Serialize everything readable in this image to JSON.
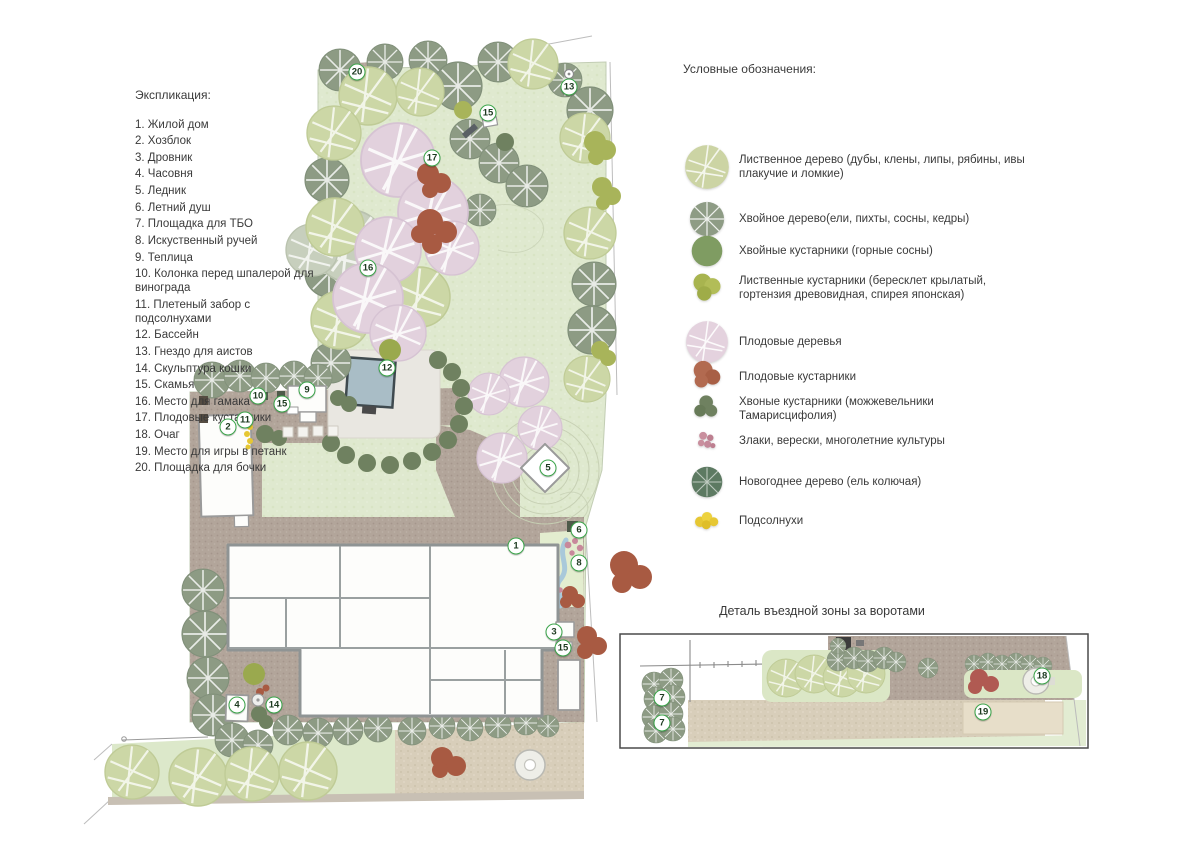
{
  "explication": {
    "title": "Экспликация:",
    "items": [
      {
        "num": "1",
        "label": "Жилой дом"
      },
      {
        "num": "2",
        "label": "Хозблок"
      },
      {
        "num": "3",
        "label": "Дровник"
      },
      {
        "num": "4",
        "label": "Часовня"
      },
      {
        "num": "5",
        "label": "Ледник"
      },
      {
        "num": "6",
        "label": "Летний душ"
      },
      {
        "num": "7",
        "label": "Площадка для ТБО"
      },
      {
        "num": "8",
        "label": "Искуственный ручей"
      },
      {
        "num": "9",
        "label": "Теплица"
      },
      {
        "num": "10",
        "label": "Колонка перед шпалерой для винограда"
      },
      {
        "num": "11",
        "label": "Плетеный забор с подсолнухами"
      },
      {
        "num": "12",
        "label": "Бассейн"
      },
      {
        "num": "13",
        "label": "Гнездо для аистов"
      },
      {
        "num": "14",
        "label": "Скульптура кошки"
      },
      {
        "num": "15",
        "label": "Скамья"
      },
      {
        "num": "16",
        "label": "Место для гамака"
      },
      {
        "num": "17",
        "label": "Плодовые кустарники"
      },
      {
        "num": "18",
        "label": "Очаг"
      },
      {
        "num": "19",
        "label": "Место для игры в петанк"
      },
      {
        "num": "20",
        "label": "Площадка для бочки"
      }
    ]
  },
  "legend": {
    "title": "Условные обозначения:",
    "items": [
      {
        "icon": "deciduous-tree-icon",
        "label": "Лиственное дерево (дубы, клены, липы, рябины, ивы плакучие и ломкие)",
        "y": 82
      },
      {
        "icon": "conifer-tree-icon",
        "label": "Хвойное дерево(ели, пихты, сосны, кедры)",
        "y": 138
      },
      {
        "icon": "conifer-shrub-icon",
        "label": "Хвойные кустарники (горные сосны)",
        "y": 172
      },
      {
        "icon": "deciduous-shrub-icon",
        "label": "Лиственные кустарники (бересклет крылатый, гортензия древовидная, спирея японская)",
        "y": 208
      },
      {
        "icon": "fruit-tree-icon",
        "label": "Плодовые деревья",
        "y": 258
      },
      {
        "icon": "fruit-shrub-icon",
        "label": "Плодовые кустарники",
        "y": 296
      },
      {
        "icon": "juniper-shrub-icon",
        "label": "Хвоные кустарники (можжевельники Тамарисцифолия)",
        "y": 330
      },
      {
        "icon": "grasses-icon",
        "label": "Злаки, верески, многолетние культуры",
        "y": 366
      },
      {
        "icon": "new-year-tree-icon",
        "label": "Новогоднее дерево (ель колючая)",
        "y": 402
      },
      {
        "icon": "sunflowers-icon",
        "label": "Подсолнухи",
        "y": 444
      }
    ]
  },
  "detail": {
    "title": "Деталь въездной зоны за воротами",
    "markers": [
      {
        "label": "7",
        "x": 662,
        "y": 698
      },
      {
        "label": "7",
        "x": 662,
        "y": 723
      },
      {
        "label": "18",
        "x": 1042,
        "y": 676
      },
      {
        "label": "19",
        "x": 983,
        "y": 712
      }
    ]
  },
  "plan": {
    "markers": [
      {
        "label": "20",
        "x": 357,
        "y": 72
      },
      {
        "label": "13",
        "x": 569,
        "y": 87
      },
      {
        "label": "15",
        "x": 488,
        "y": 113
      },
      {
        "label": "17",
        "x": 432,
        "y": 158
      },
      {
        "label": "16",
        "x": 368,
        "y": 268
      },
      {
        "label": "12",
        "x": 387,
        "y": 368
      },
      {
        "label": "9",
        "x": 307,
        "y": 390
      },
      {
        "label": "10",
        "x": 258,
        "y": 396
      },
      {
        "label": "15",
        "x": 282,
        "y": 404
      },
      {
        "label": "2",
        "x": 228,
        "y": 427
      },
      {
        "label": "11",
        "x": 245,
        "y": 420
      },
      {
        "label": "5",
        "x": 548,
        "y": 468
      },
      {
        "label": "6",
        "x": 579,
        "y": 530
      },
      {
        "label": "1",
        "x": 516,
        "y": 546
      },
      {
        "label": "8",
        "x": 579,
        "y": 563
      },
      {
        "label": "3",
        "x": 554,
        "y": 632
      },
      {
        "label": "15",
        "x": 563,
        "y": 648
      },
      {
        "label": "4",
        "x": 237,
        "y": 705
      },
      {
        "label": "14",
        "x": 274,
        "y": 705
      }
    ]
  },
  "colors": {
    "lawn": "#dfe9cf",
    "paving": "#b2a59a",
    "path_beige": "#d8ceba",
    "deciduous_tree": "#ccd7a6",
    "gray_deciduous_tree": "#c7cfbd",
    "conifer_tree": "#8d9b84",
    "conifer_shrub": "#6f8160",
    "deciduous_shrub": "#a8b45a",
    "fruit_tree": "#e2d1dd",
    "fruit_shrub": "#a85a42",
    "grasses": "#c98f9e",
    "new_year_tree": "#5d7a62",
    "sunflower": "#e6c733",
    "pool_water": "#a9bdc6",
    "marker_ring": "#3aa449",
    "text": "#3a3a3a"
  }
}
